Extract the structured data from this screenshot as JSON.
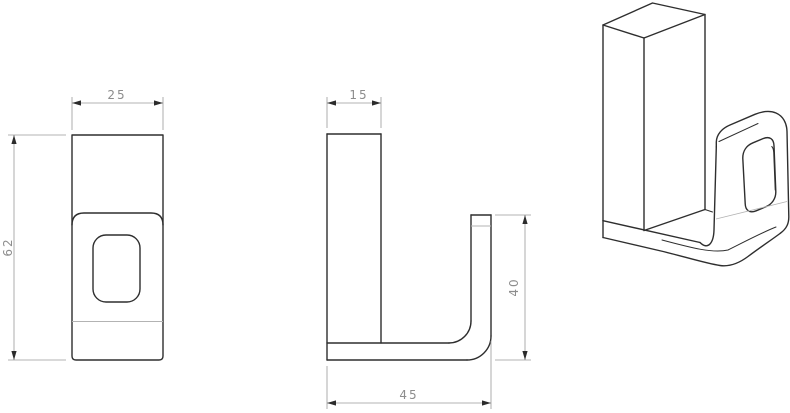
{
  "drawing": {
    "kind": "technical-drawing-hook",
    "colors": {
      "background": "#ffffff",
      "object_line": "#2e2e2e",
      "tangent_line": "#b3b3b3",
      "dimension_line": "#9a9a9a",
      "dimension_text": "#8d8d8d"
    },
    "views": {
      "front": {
        "width": "25",
        "height": "62"
      },
      "side": {
        "thickness": "15",
        "hook_height": "40",
        "length": "45"
      }
    }
  }
}
